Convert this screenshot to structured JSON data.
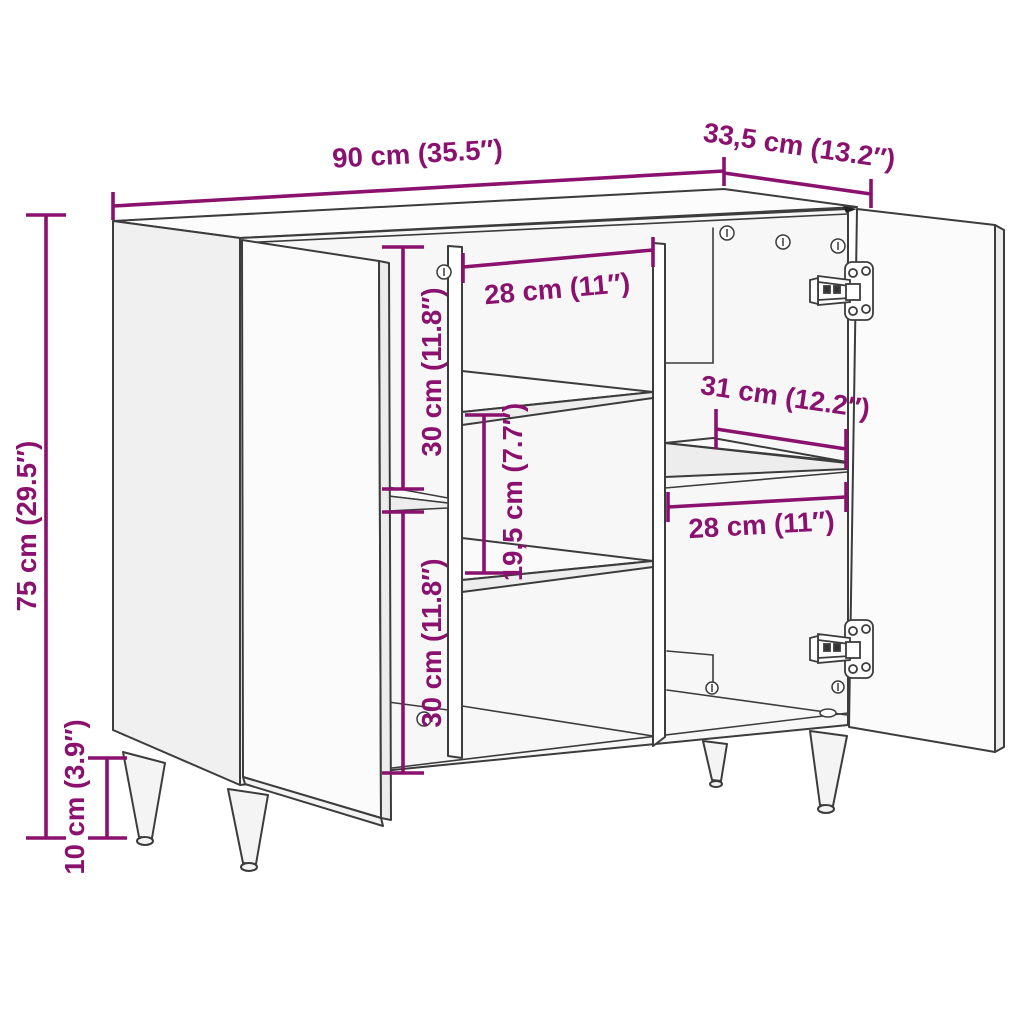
{
  "figure": {
    "type": "furniture-dimension-diagram",
    "subject": "sideboard with two open doors, interior shelves and tapered legs"
  },
  "colors": {
    "dimension_accent": "#8B116E",
    "line_art": "#3C3C3C",
    "background": "#FFFFFF"
  },
  "dimensions": {
    "overall": {
      "width": "90 cm (35.5″)",
      "depth": "33,5 cm (13.2″)",
      "height": "75 cm (29.5″)",
      "leg_height": "10 cm (3.9″)"
    },
    "interior": {
      "middle_top_width": "28 cm (11″)",
      "upper_left_height": "30 cm (11.8″)",
      "lower_left_height": "30 cm (11.8″)",
      "middle_shelf_gap": "19,5 cm (7.7″)",
      "right_shelf_depth": "31 cm (12.2″)",
      "right_lower_width": "28 cm (11″)"
    }
  }
}
